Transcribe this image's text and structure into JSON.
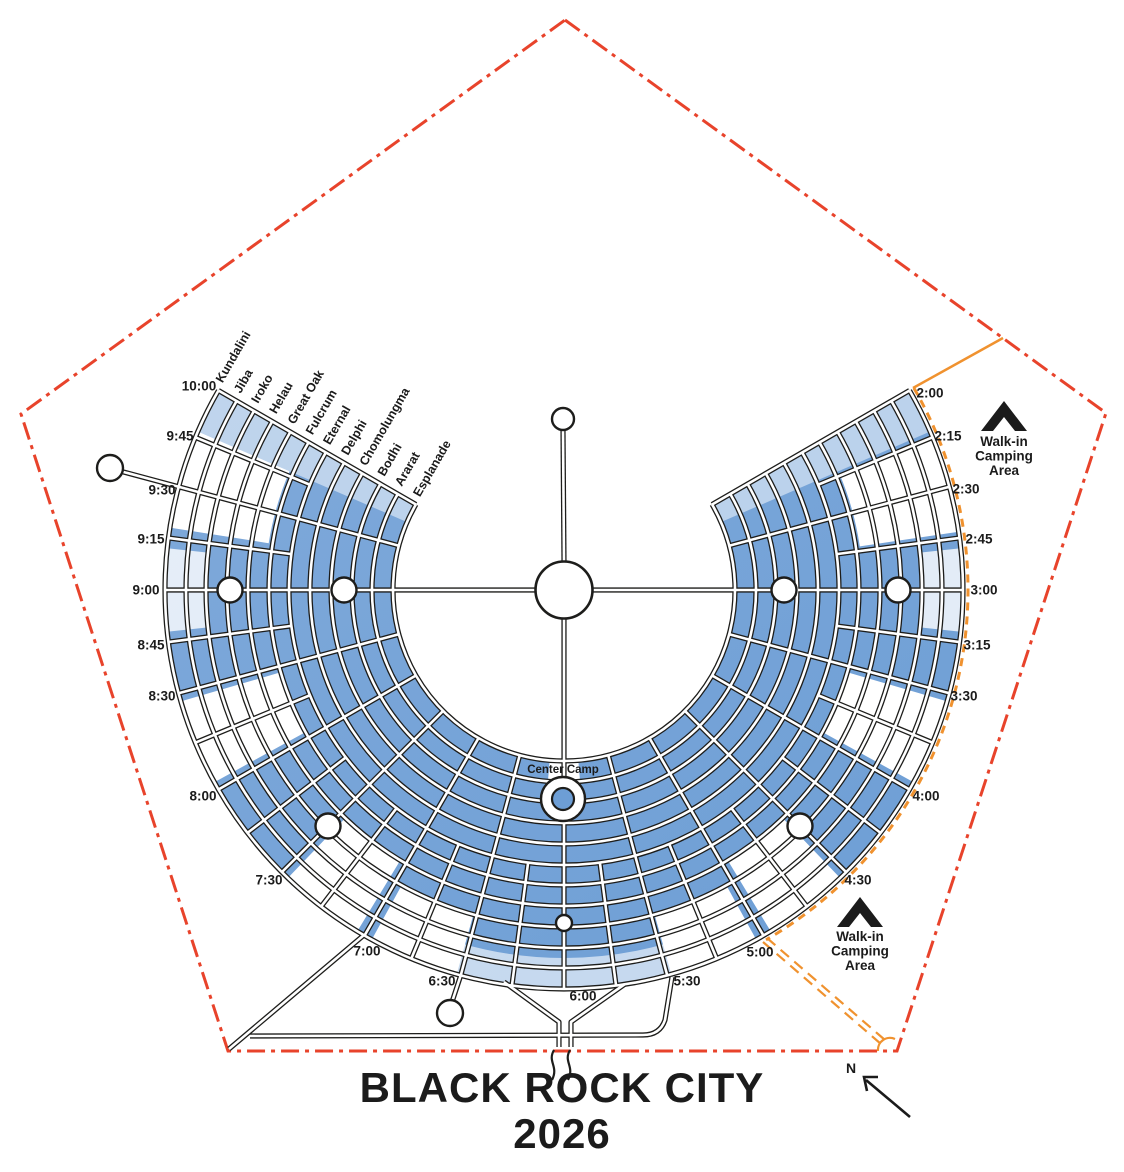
{
  "title": {
    "line1": "BLACK ROCK CITY",
    "line2": "2026"
  },
  "colors": {
    "fence": "#e8432b",
    "walk_in": "#f0922f",
    "camp_fill": "#6d9ed5",
    "camp_fill_light": "#7fa9da",
    "road_casing": "#1d1d1b",
    "road_fill": "#ffffff",
    "text": "#1b1b1b",
    "background": "#ffffff"
  },
  "map": {
    "center": {
      "x": 564,
      "y": 590
    },
    "pentagon_fence": [
      [
        565,
        20
      ],
      [
        1106,
        413
      ],
      [
        897,
        1051
      ],
      [
        228,
        1051
      ],
      [
        21,
        414
      ]
    ],
    "ring_streets": [
      {
        "name": "Esplanade",
        "r": 171
      },
      {
        "name": "Ararat",
        "r": 192
      },
      {
        "name": "Bodhi",
        "r": 212
      },
      {
        "name": "Chomolungma",
        "r": 233
      },
      {
        "name": "Delphi",
        "r": 254
      },
      {
        "name": "Eternal",
        "r": 275
      },
      {
        "name": "Fulcrum",
        "r": 295
      },
      {
        "name": "Great Oak",
        "r": 316
      },
      {
        "name": "Helau",
        "r": 337
      },
      {
        "name": "Iroko",
        "r": 358
      },
      {
        "name": "Jiba",
        "r": 378
      },
      {
        "name": "Kundalini",
        "r": 399
      }
    ],
    "city_span_hours": [
      2,
      10
    ],
    "radial_streets_full": [
      2,
      2.5,
      3,
      3.5,
      4,
      4.5,
      5,
      5.5,
      6,
      6.5,
      7,
      7.5,
      8,
      8.5,
      9,
      9.5,
      10
    ],
    "radial_streets_quarter": [
      2.25,
      2.75,
      3.25,
      3.75,
      4.25,
      4.75,
      5.25,
      5.75,
      6.25,
      6.75,
      7.25,
      7.75,
      8.25,
      8.75,
      9.25,
      9.75
    ],
    "quarter_inner_r": 275,
    "time_labels": [
      {
        "label": "10:00",
        "x": 199,
        "y": 386
      },
      {
        "label": "9:45",
        "x": 180,
        "y": 436
      },
      {
        "label": "9:30",
        "x": 162,
        "y": 490
      },
      {
        "label": "9:15",
        "x": 151,
        "y": 539
      },
      {
        "label": "9:00",
        "x": 146,
        "y": 590
      },
      {
        "label": "8:45",
        "x": 151,
        "y": 645
      },
      {
        "label": "8:30",
        "x": 162,
        "y": 696
      },
      {
        "label": "8:00",
        "x": 203,
        "y": 796
      },
      {
        "label": "7:30",
        "x": 269,
        "y": 880
      },
      {
        "label": "7:00",
        "x": 367,
        "y": 951
      },
      {
        "label": "6:30",
        "x": 442,
        "y": 981
      },
      {
        "label": "6:00",
        "x": 583,
        "y": 996
      },
      {
        "label": "5:30",
        "x": 687,
        "y": 981
      },
      {
        "label": "5:00",
        "x": 760,
        "y": 952
      },
      {
        "label": "4:30",
        "x": 858,
        "y": 880
      },
      {
        "label": "4:00",
        "x": 926,
        "y": 796
      },
      {
        "label": "3:30",
        "x": 964,
        "y": 696
      },
      {
        "label": "3:15",
        "x": 977,
        "y": 645
      },
      {
        "label": "3:00",
        "x": 984,
        "y": 590
      },
      {
        "label": "2:45",
        "x": 979,
        "y": 539
      },
      {
        "label": "2:30",
        "x": 966,
        "y": 489
      },
      {
        "label": "2:15",
        "x": 948,
        "y": 436
      },
      {
        "label": "2:00",
        "x": 930,
        "y": 393
      }
    ],
    "white_blocks": [
      [
        9.78,
        10.0,
        171,
        399,
        0.5
      ],
      [
        9.3,
        9.78,
        299,
        399,
        1
      ],
      [
        8.8,
        9.2,
        358,
        399,
        0.8
      ],
      [
        8.04,
        8.46,
        295,
        399,
        1
      ],
      [
        7.04,
        7.46,
        316,
        399,
        1
      ],
      [
        6.52,
        6.96,
        337,
        399,
        1
      ],
      [
        5.45,
        6.55,
        368,
        399,
        0.6
      ],
      [
        5.04,
        5.48,
        337,
        399,
        1
      ],
      [
        4.54,
        4.96,
        316,
        399,
        1
      ],
      [
        3.54,
        3.96,
        295,
        399,
        1
      ],
      [
        2.8,
        3.2,
        358,
        399,
        0.8
      ],
      [
        2.24,
        2.72,
        299,
        399,
        1
      ],
      [
        2.0,
        2.22,
        171,
        399,
        0.5
      ],
      [
        5.84,
        6.16,
        171,
        206,
        1
      ]
    ],
    "plazas": [
      {
        "x": 344,
        "y": 590,
        "r": 12.5
      },
      {
        "x": 230,
        "y": 590,
        "r": 12.5
      },
      {
        "x": 784,
        "y": 590,
        "r": 12.5
      },
      {
        "x": 898,
        "y": 590,
        "r": 12.5
      },
      {
        "x": 328,
        "y": 826,
        "r": 12.5
      },
      {
        "x": 800,
        "y": 826,
        "r": 12.5
      },
      {
        "x": 564,
        "y": 923,
        "r": 8
      }
    ],
    "portal_circles": [
      {
        "x": 110,
        "y": 468,
        "r": 13
      },
      {
        "x": 450,
        "y": 1013,
        "r": 13
      }
    ],
    "man": {
      "x": 564,
      "y": 590,
      "r": 28.5
    },
    "temple": {
      "x": 563,
      "y": 419,
      "r": 11
    },
    "center_camp": {
      "label": "Center Camp",
      "x": 563,
      "y": 799,
      "outer_r": 22,
      "inner_r": 11,
      "label_x": 563,
      "label_y": 773
    },
    "walk_in_areas": [
      {
        "lines": [
          "Walk-in",
          "Camping",
          "Area"
        ],
        "x": 1004,
        "tent_y": 417,
        "text_y": 442
      },
      {
        "lines": [
          "Walk-in",
          "Camping",
          "Area"
        ],
        "x": 860,
        "tent_y": 913,
        "text_y": 937
      }
    ],
    "north_arrow": {
      "label": "N",
      "label_x": 851,
      "label_y": 1073
    }
  }
}
